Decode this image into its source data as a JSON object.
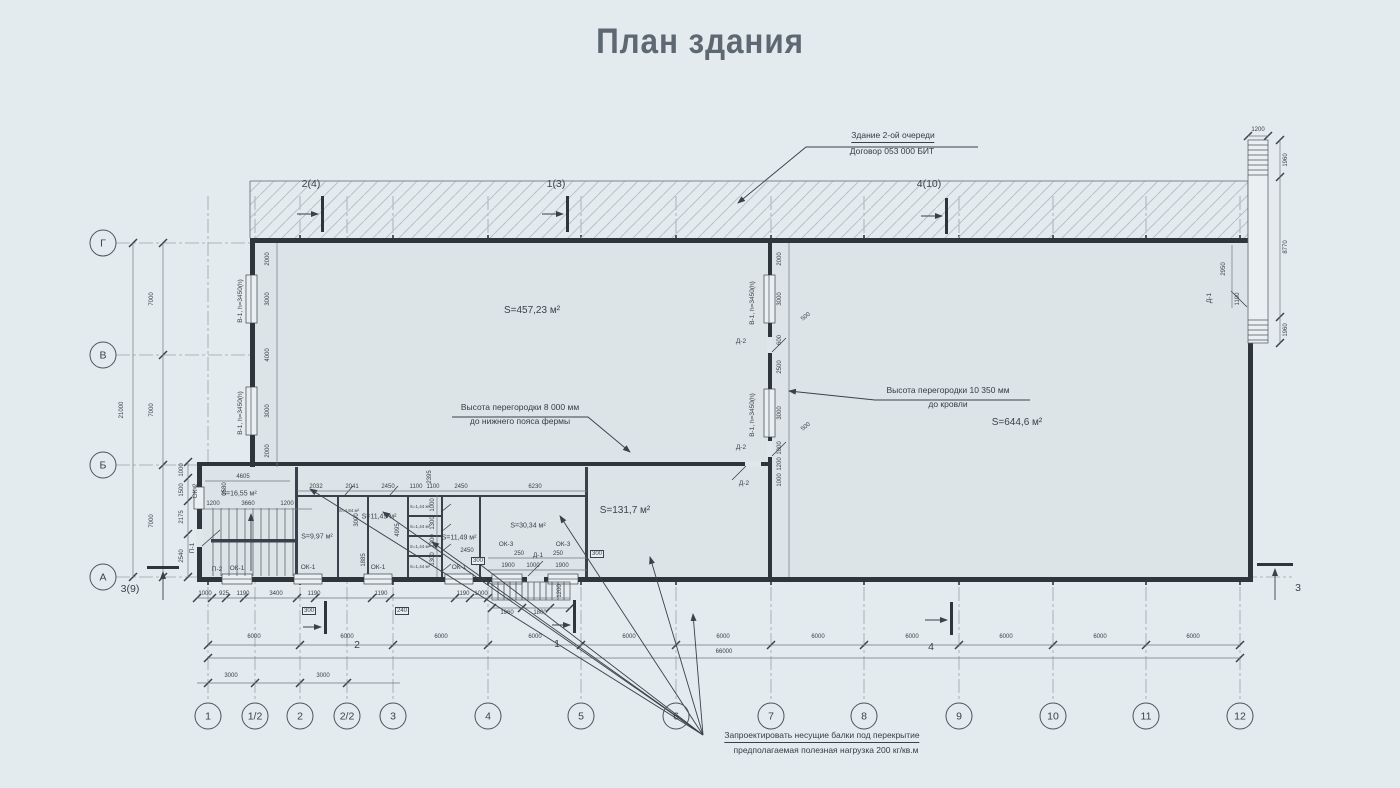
{
  "title": "План здания",
  "colors": {
    "background": "#e4ebee",
    "ink": "#2e353b",
    "title": "#5d6872"
  },
  "callout_phase2": {
    "line1": "Здание 2-ой очереди",
    "line2": "Договор 053 000 БИТ"
  },
  "notes": {
    "partition_left1": "Высота перегородки 8 000 мм",
    "partition_left2": "до нижнего пояса фермы",
    "partition_right1": "Высота перегородки 10 350 мм",
    "partition_right2": "до кровли",
    "beams1": "Запроектировать несущие балки под перекрытие",
    "beams2": "предполагаемая полезная нагрузка 200 кг/кв.м"
  },
  "grid": {
    "columns": [
      {
        "label": "1",
        "x": 208
      },
      {
        "label": "1/2",
        "x": 255
      },
      {
        "label": "2",
        "x": 300
      },
      {
        "label": "2/2",
        "x": 347
      },
      {
        "label": "3",
        "x": 393
      },
      {
        "label": "4",
        "x": 488
      },
      {
        "label": "5",
        "x": 581
      },
      {
        "label": "6",
        "x": 676
      },
      {
        "label": "7",
        "x": 771
      },
      {
        "label": "8",
        "x": 864
      },
      {
        "label": "9",
        "x": 959
      },
      {
        "label": "10",
        "x": 1053
      },
      {
        "label": "11",
        "x": 1146
      },
      {
        "label": "12",
        "x": 1240
      }
    ],
    "rows": [
      {
        "label": "Г",
        "y": 243
      },
      {
        "label": "В",
        "y": 355
      },
      {
        "label": "Б",
        "y": 465
      },
      {
        "label": "А",
        "y": 577
      }
    ]
  },
  "sections": [
    {
      "t": "2(4)",
      "x": 311,
      "y": 184
    },
    {
      "t": "1(3)",
      "x": 556,
      "y": 184
    },
    {
      "t": "4(10)",
      "x": 929,
      "y": 184
    },
    {
      "t": "2",
      "x": 357,
      "y": 645
    },
    {
      "t": "1",
      "x": 557,
      "y": 644
    },
    {
      "t": "4",
      "x": 931,
      "y": 647
    },
    {
      "t": "3",
      "x": 1298,
      "y": 588
    },
    {
      "t": "3(9)",
      "x": 130,
      "y": 589
    }
  ],
  "rooms": [
    {
      "t": "S=457,23 м²",
      "x": 532,
      "y": 311
    },
    {
      "t": "S=644,6 м²",
      "x": 1017,
      "y": 423
    },
    {
      "t": "S=131,7 м²",
      "x": 625,
      "y": 511
    },
    {
      "t": "S=16,55 м²",
      "x": 239,
      "y": 494,
      "sm": 1
    },
    {
      "t": "S=9,97 м²",
      "x": 317,
      "y": 537,
      "sm": 1
    },
    {
      "t": "S=11,49 м²",
      "x": 379,
      "y": 517,
      "sm": 1
    },
    {
      "t": "S=11,49 м²",
      "x": 459,
      "y": 538,
      "sm": 1
    },
    {
      "t": "S=30,34 м²",
      "x": 528,
      "y": 526,
      "sm": 1
    },
    {
      "t": "S=4,84 м²",
      "x": 349,
      "y": 511,
      "xs": 1
    },
    {
      "t": "S=1,44 м²",
      "x": 420,
      "y": 507,
      "xs": 1
    },
    {
      "t": "S=1,44 м²",
      "x": 420,
      "y": 527,
      "xs": 1
    },
    {
      "t": "S=1,44 м²",
      "x": 420,
      "y": 547,
      "xs": 1
    },
    {
      "t": "S=1,44 м²",
      "x": 420,
      "y": 567,
      "xs": 1
    }
  ],
  "tags": [
    {
      "t": "В-1, h=3450(h)",
      "x": 241,
      "y": 301,
      "r": -90
    },
    {
      "t": "В-1, h=3450(h)",
      "x": 241,
      "y": 413,
      "r": -90
    },
    {
      "t": "В-1, h=3450(h)",
      "x": 753,
      "y": 303,
      "r": -90
    },
    {
      "t": "В-1, h=3450(h)",
      "x": 753,
      "y": 415,
      "r": -90
    },
    {
      "t": "Д-2",
      "x": 741,
      "y": 342
    },
    {
      "t": "Д-2",
      "x": 741,
      "y": 448
    },
    {
      "t": "Д-2",
      "x": 744,
      "y": 484
    },
    {
      "t": "Д-1",
      "x": 1210,
      "y": 298,
      "r": -90
    },
    {
      "t": "Д-1",
      "x": 538,
      "y": 556
    },
    {
      "t": "ОК-1",
      "x": 237,
      "y": 569
    },
    {
      "t": "ОК-1",
      "x": 308,
      "y": 568
    },
    {
      "t": "ОК-1",
      "x": 378,
      "y": 568
    },
    {
      "t": "ОК-1",
      "x": 459,
      "y": 568
    },
    {
      "t": "ОК-2",
      "x": 196,
      "y": 491,
      "r": -90
    },
    {
      "t": "ОК-3",
      "x": 506,
      "y": 545
    },
    {
      "t": "ОК-3",
      "x": 563,
      "y": 545
    },
    {
      "t": "П-1",
      "x": 193,
      "y": 548,
      "r": -90
    },
    {
      "t": "П-2",
      "x": 217,
      "y": 570
    }
  ],
  "dims": [
    {
      "t": "7000",
      "x": 152,
      "y": 299,
      "r": -90
    },
    {
      "t": "7000",
      "x": 152,
      "y": 410,
      "r": -90
    },
    {
      "t": "7000",
      "x": 152,
      "y": 521,
      "r": -90
    },
    {
      "t": "21000",
      "x": 122,
      "y": 410,
      "r": -90
    },
    {
      "t": "6000",
      "x": 254,
      "y": 637
    },
    {
      "t": "6000",
      "x": 347,
      "y": 637
    },
    {
      "t": "6000",
      "x": 441,
      "y": 637
    },
    {
      "t": "6000",
      "x": 535,
      "y": 637
    },
    {
      "t": "6000",
      "x": 629,
      "y": 637
    },
    {
      "t": "6000",
      "x": 723,
      "y": 637
    },
    {
      "t": "6000",
      "x": 818,
      "y": 637
    },
    {
      "t": "6000",
      "x": 912,
      "y": 637
    },
    {
      "t": "6000",
      "x": 1006,
      "y": 637
    },
    {
      "t": "6000",
      "x": 1100,
      "y": 637
    },
    {
      "t": "6000",
      "x": 1193,
      "y": 637
    },
    {
      "t": "66000",
      "x": 724,
      "y": 652
    },
    {
      "t": "3000",
      "x": 231,
      "y": 676
    },
    {
      "t": "3000",
      "x": 323,
      "y": 676
    },
    {
      "t": "2000",
      "x": 268,
      "y": 259,
      "r": -90
    },
    {
      "t": "3000",
      "x": 268,
      "y": 299,
      "r": -90
    },
    {
      "t": "4000",
      "x": 268,
      "y": 355,
      "r": -90
    },
    {
      "t": "3000",
      "x": 268,
      "y": 411,
      "r": -90
    },
    {
      "t": "2000",
      "x": 268,
      "y": 451,
      "r": -90
    },
    {
      "t": "2000",
      "x": 780,
      "y": 259,
      "r": -90
    },
    {
      "t": "3000",
      "x": 780,
      "y": 299,
      "r": -90
    },
    {
      "t": "500",
      "x": 806,
      "y": 317,
      "r": -38
    },
    {
      "t": "600",
      "x": 780,
      "y": 340,
      "r": -90
    },
    {
      "t": "2500",
      "x": 780,
      "y": 367,
      "r": -90
    },
    {
      "t": "3000",
      "x": 780,
      "y": 413,
      "r": -90
    },
    {
      "t": "500",
      "x": 806,
      "y": 427,
      "r": -38
    },
    {
      "t": "1000",
      "x": 780,
      "y": 448,
      "r": -90
    },
    {
      "t": "1200",
      "x": 780,
      "y": 464,
      "r": -90
    },
    {
      "t": "1000",
      "x": 780,
      "y": 480,
      "r": -90
    },
    {
      "t": "1200",
      "x": 1258,
      "y": 130
    },
    {
      "t": "1960",
      "x": 1286,
      "y": 160,
      "r": -90
    },
    {
      "t": "8770",
      "x": 1286,
      "y": 247,
      "r": -90
    },
    {
      "t": "1960",
      "x": 1286,
      "y": 330,
      "r": -90
    },
    {
      "t": "2950",
      "x": 1224,
      "y": 269,
      "r": -90
    },
    {
      "t": "1100",
      "x": 1238,
      "y": 299,
      "r": -90
    },
    {
      "t": "4605",
      "x": 243,
      "y": 477
    },
    {
      "t": "1200",
      "x": 213,
      "y": 504
    },
    {
      "t": "3660",
      "x": 248,
      "y": 504
    },
    {
      "t": "1200",
      "x": 287,
      "y": 504
    },
    {
      "t": "3580",
      "x": 225,
      "y": 489,
      "r": -90
    },
    {
      "t": "1000",
      "x": 182,
      "y": 470,
      "r": -90
    },
    {
      "t": "1500",
      "x": 182,
      "y": 490,
      "r": -90
    },
    {
      "t": "2175",
      "x": 182,
      "y": 517,
      "r": -90
    },
    {
      "t": "2540",
      "x": 182,
      "y": 556,
      "r": -90
    },
    {
      "t": "2032",
      "x": 316,
      "y": 487
    },
    {
      "t": "2041",
      "x": 352,
      "y": 487
    },
    {
      "t": "2450",
      "x": 388,
      "y": 487
    },
    {
      "t": "1100",
      "x": 416,
      "y": 487
    },
    {
      "t": "1100",
      "x": 433,
      "y": 487
    },
    {
      "t": "2450",
      "x": 461,
      "y": 487
    },
    {
      "t": "6230",
      "x": 535,
      "y": 487
    },
    {
      "t": "2395",
      "x": 430,
      "y": 477,
      "r": -90
    },
    {
      "t": "3000",
      "x": 357,
      "y": 520,
      "r": -90
    },
    {
      "t": "4995",
      "x": 398,
      "y": 530,
      "r": -90
    },
    {
      "t": "1885",
      "x": 364,
      "y": 560,
      "r": -90
    },
    {
      "t": "1000",
      "x": 433,
      "y": 505,
      "r": -90
    },
    {
      "t": "1300",
      "x": 433,
      "y": 523,
      "r": -90
    },
    {
      "t": "1300",
      "x": 433,
      "y": 541,
      "r": -90
    },
    {
      "t": "1300",
      "x": 433,
      "y": 559,
      "r": -90
    },
    {
      "t": "2450",
      "x": 467,
      "y": 551
    },
    {
      "t": "300",
      "x": 478,
      "y": 561,
      "b": 1
    },
    {
      "t": "250",
      "x": 519,
      "y": 554
    },
    {
      "t": "250",
      "x": 558,
      "y": 554
    },
    {
      "t": "1900",
      "x": 508,
      "y": 566
    },
    {
      "t": "1000",
      "x": 533,
      "y": 566
    },
    {
      "t": "1900",
      "x": 562,
      "y": 566
    },
    {
      "t": "300",
      "x": 597,
      "y": 554,
      "b": 1
    },
    {
      "t": "1000",
      "x": 205,
      "y": 594
    },
    {
      "t": "925",
      "x": 224,
      "y": 594
    },
    {
      "t": "1190",
      "x": 243,
      "y": 594
    },
    {
      "t": "3400",
      "x": 276,
      "y": 594
    },
    {
      "t": "1190",
      "x": 314,
      "y": 594
    },
    {
      "t": "1190",
      "x": 381,
      "y": 594
    },
    {
      "t": "1190",
      "x": 463,
      "y": 594
    },
    {
      "t": "1000",
      "x": 481,
      "y": 594
    },
    {
      "t": "300",
      "x": 309,
      "y": 611,
      "b": 1
    },
    {
      "t": "240",
      "x": 402,
      "y": 611,
      "b": 1
    },
    {
      "t": "1960",
      "x": 507,
      "y": 613
    },
    {
      "t": "1800",
      "x": 540,
      "y": 613
    },
    {
      "t": "1200",
      "x": 560,
      "y": 591,
      "r": -90
    }
  ]
}
